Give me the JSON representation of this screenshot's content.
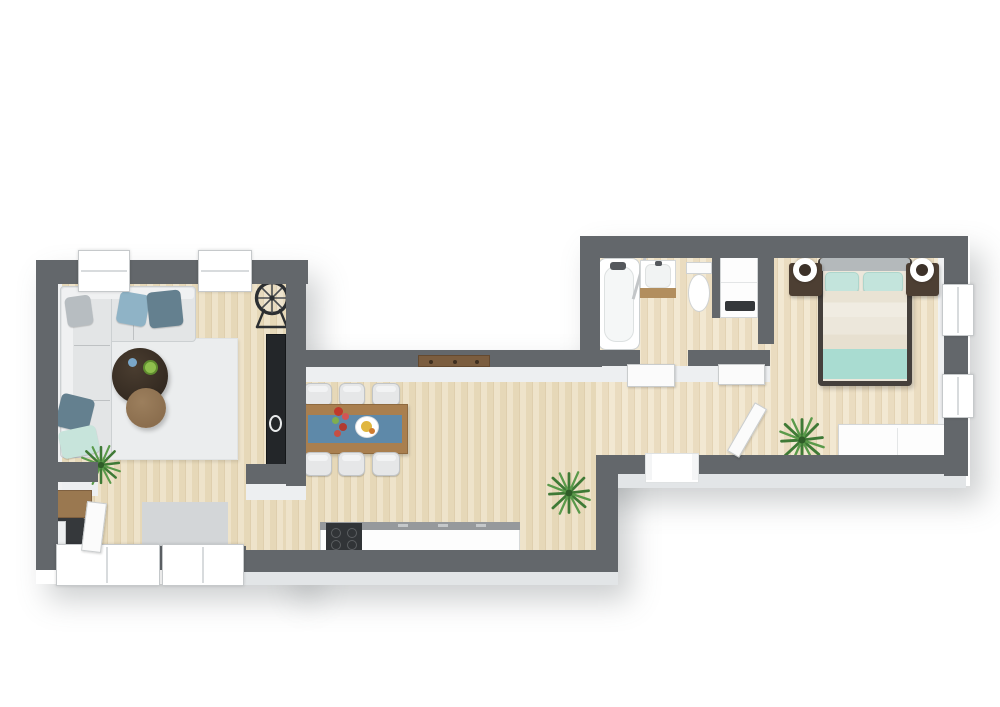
{
  "meta": {
    "title": "Top-down 3D apartment floor plan render",
    "visible_text": "none",
    "canvas": {
      "width": 1000,
      "height": 707
    }
  },
  "palette": {
    "wall": "#63676b",
    "wall_face": "#edeff1",
    "floor_wood": "#e8dcc0",
    "rug_white": "#ebedee",
    "rug_gray": "#d3d6d8",
    "sofa": "#e3e5e6",
    "pillow_blue": "#8fb3c6",
    "pillow_slate": "#64808f",
    "pillow_gray": "#b7bdc1",
    "pillow_mint": "#c7e4db",
    "coffee_table_dark": "#342a21",
    "coffee_table_brown": "#8b6e4e",
    "dining_table": "#a97f4f",
    "table_runner": "#5e89a9",
    "chair": "#e6e7e8",
    "counter_edge": "#96999c",
    "cooktop": "#313437",
    "tv_unit": "#232629",
    "bed_frame": "#45403c",
    "headboard": "#b4b9bb",
    "duvet": "#ece7db",
    "blanket_mint": "#a9dcd1",
    "nightstand": "#4d3f33",
    "vanity_wood": "#b28e5e",
    "shelf_wood": "#7b5d3f",
    "desk_wood": "#9a7850",
    "plant_green": "#3f7a36"
  },
  "rooms": {
    "living": {
      "label": "Living room",
      "furniture": [
        "corner sofa with five cushions",
        "round dark coffee table",
        "round brown side table",
        "white area rug",
        "floor plant",
        "black TV sideboard",
        "decorative wheel on stand",
        "two top windows",
        "two bottom windows",
        "entry door",
        "desk nook with wooden desk, dark chair and monitor",
        "gray floor mat"
      ]
    },
    "kitchen_dining": {
      "label": "Kitchen and dining area",
      "furniture": [
        "wooden dining table with blue runner",
        "six white chairs",
        "flower vase",
        "plate with food",
        "kitchen counter run",
        "dark cooktop",
        "wall-mounted wooden shelf",
        "floor plant"
      ]
    },
    "bathroom": {
      "label": "Bathroom",
      "furniture": [
        "bathtub with faucet",
        "glass shower screen",
        "vanity sink with wood cabinet",
        "toilet",
        "washing machine closet",
        "open door"
      ]
    },
    "hallway": {
      "label": "Hallway",
      "furniture": [
        "entry opening with sill",
        "bathroom door leaf",
        "closet door leaf",
        "bedroom door leaf"
      ]
    },
    "bedroom": {
      "label": "Bedroom",
      "furniture": [
        "double bed with teal pillows and blanket",
        "gray headboard",
        "two dark wood nightstands",
        "two white ring lamps",
        "white dresser",
        "floor plant",
        "two right-wall windows"
      ]
    }
  }
}
